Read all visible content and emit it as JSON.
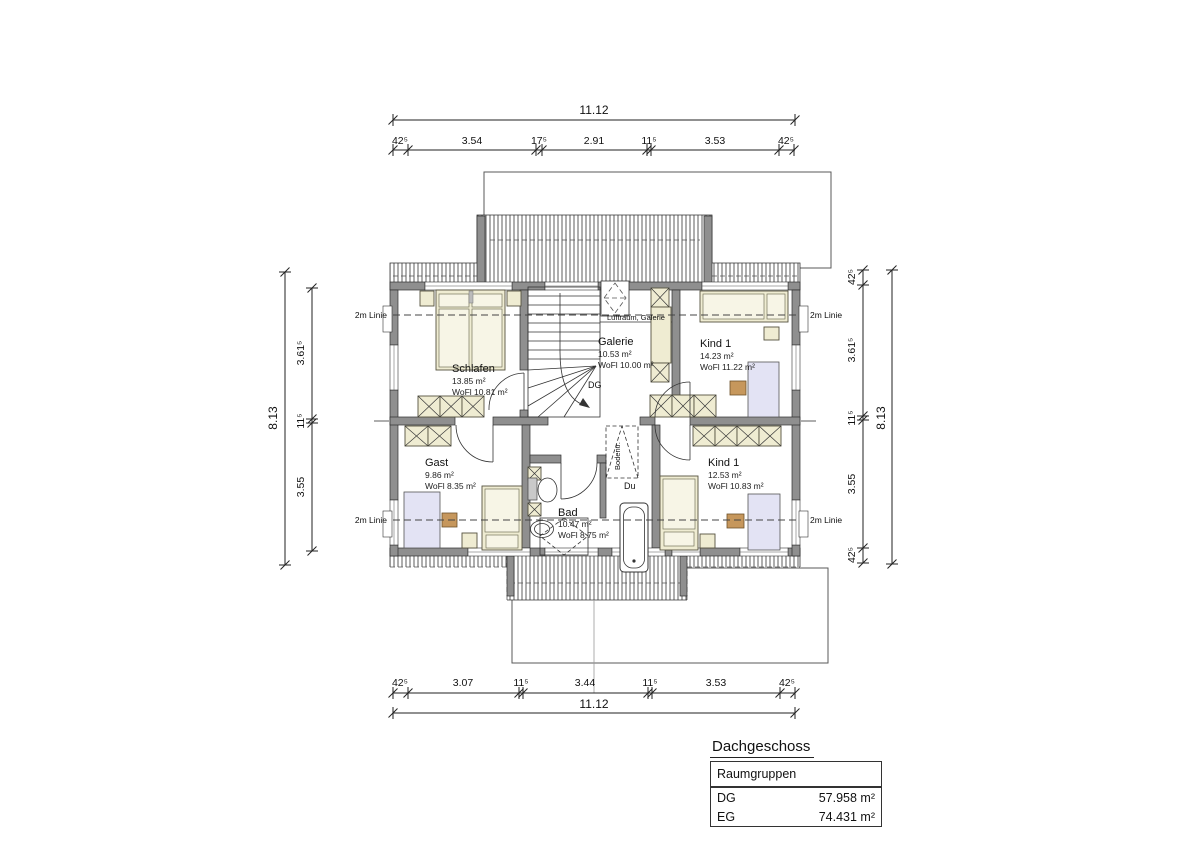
{
  "title_block": {
    "title": "Dachgeschoss",
    "group_header": "Raumgruppen",
    "rows": [
      {
        "label": "DG",
        "value": "57.958 m²"
      },
      {
        "label": "EG",
        "value": "74.431 m²"
      }
    ]
  },
  "dimensions": {
    "top": {
      "total": "11.12",
      "chain": [
        "42⁵",
        "3.54",
        "17⁵",
        "2.91",
        "11⁵",
        "3.53",
        "42⁵"
      ]
    },
    "bottom": {
      "chain": [
        "42⁵",
        "3.07",
        "11⁵",
        "3.44",
        "11⁵",
        "3.53",
        "42⁵"
      ],
      "total": "11.12"
    },
    "left": {
      "total": "8.13",
      "chain": [
        "3.61⁵",
        "11⁵",
        "3.55"
      ]
    },
    "right": {
      "chain": [
        "42⁵",
        "3.61⁵",
        "11⁵",
        "3.55",
        "42⁵"
      ],
      "total": "8.13"
    }
  },
  "rooms": {
    "schlafen": {
      "name": "Schlafen",
      "area": "13.85 m²",
      "wofl": "WoFl 10.81 m²"
    },
    "galerie": {
      "name": "Galerie",
      "area": "10.53 m²",
      "wofl": "WoFl 10.00 m²"
    },
    "kind1_top": {
      "name": "Kind 1",
      "area": "14.23 m²",
      "wofl": "WoFl 11.22 m²"
    },
    "gast": {
      "name": "Gast",
      "area": "9.86 m²",
      "wofl": "WoFl 8.35 m²"
    },
    "bad": {
      "name": "Bad",
      "area": "10.47 m²",
      "wofl": "WoFl 8.75 m²"
    },
    "kind1_bottom": {
      "name": "Kind 1",
      "area": "12.53 m²",
      "wofl": "WoFl 10.83 m²"
    }
  },
  "annotations": {
    "two_m_line": "2m Linie",
    "luftraum": "Luftraum, Galerie",
    "floor_code": "DG",
    "shower": "Du",
    "attic_ladder": "Bodentr."
  },
  "colors": {
    "wall": "#8f8f8f",
    "furniture": "#efecd2",
    "furniture-light": "#f7f5e6",
    "desk": "#e3e3f4",
    "chair": "#c6975c"
  }
}
